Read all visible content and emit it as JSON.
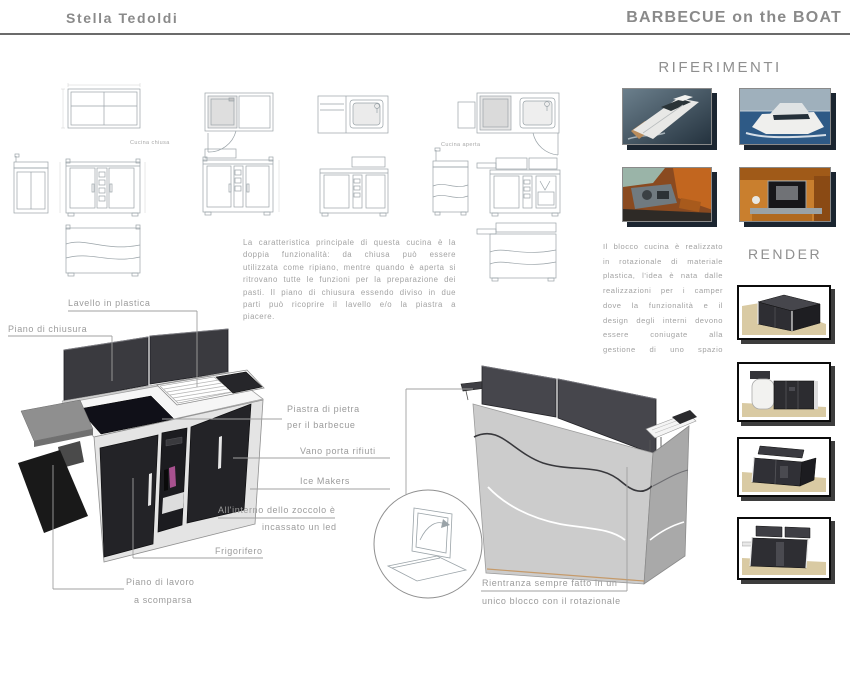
{
  "page": {
    "author": "Stella Tedoldi",
    "title": "BARBECUE on the BOAT"
  },
  "sections": {
    "riferimenti": {
      "heading": "RIFERIMENTI",
      "photos": [
        "motorboat-aerial-view",
        "yacht-cruising-at-sea",
        "boat-cockpit-interior",
        "boat-galley-interior"
      ]
    },
    "render": {
      "heading": "RENDER",
      "views": [
        "closed-unit-perspective",
        "unit-front-view",
        "open-unit-perspective",
        "open-unit-front-view"
      ]
    }
  },
  "drawings": {
    "caption_closed": "Cucina chiusa",
    "caption_open": "Cucina aperta"
  },
  "description": {
    "main": "La caratteristica principale di questa cucina è la doppia funzionalità: da chiusa può essere utilizzata come ripiano, mentre quando è aperta si ritrovano tutte le funzioni per la preparazione dei pasti. Il piano di chiusura essendo diviso in due parti può ricoprire il lavello e/o la piastra a piacere.",
    "side": "Il blocco cucina è realizzato in rotazionale di materiale plastica, l'idea è nata dalle realizzazioni per i camper dove la funzionalità e il design degli interni devono essere coniugate alla gestione di uno spazio",
    "note_line1": "Rientranza sempre fatto in un",
    "note_line2": "unico blocco con il rotazionale"
  },
  "callouts": {
    "lavello": "Lavello in plastica",
    "piano_chiusura": "Piano di chiusura",
    "piastra_l1": "Piastra di pietra",
    "piastra_l2": "per il barbecue",
    "vano": "Vano porta rifiuti",
    "ice": "Ice Makers",
    "zoccolo_l1": "All'interno dello zoccolo è",
    "zoccolo_l2": "incassato un led",
    "frigorifero": "Frigorifero",
    "piano_lavoro_l1": "Piano di lavoro",
    "piano_lavoro_l2": "a scomparsa"
  },
  "colors": {
    "text_gray": "#9b9b9b",
    "heading_gray": "#8f8f8f",
    "rule_dark": "#6b6b6b",
    "unit_dark": "#303036",
    "floor_tan": "#d9caa3",
    "sea_blue": "#2e5a86",
    "interior_orange": "#c06a28",
    "photo_shadow": "#1b2530"
  }
}
